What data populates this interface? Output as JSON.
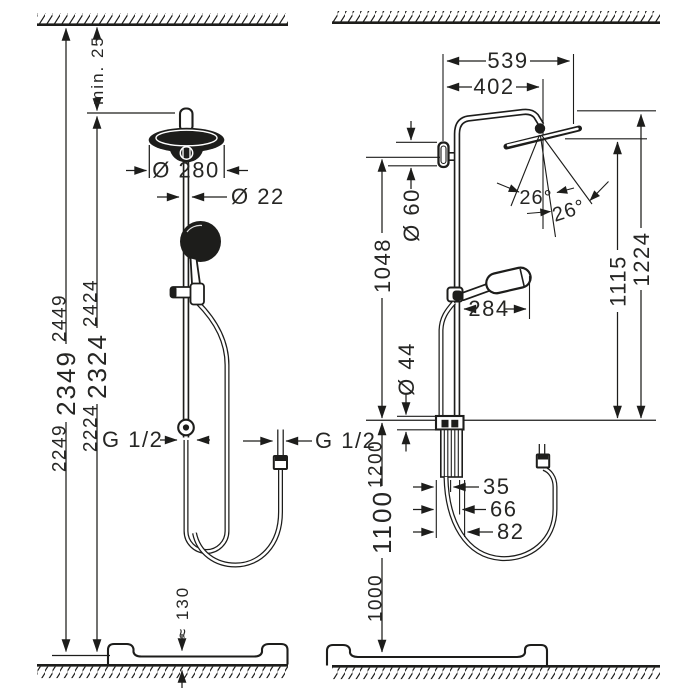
{
  "front_view": {
    "ceiling_gap": "min. 25",
    "head_diameter": "Ø 280",
    "pipe_diameter": "Ø 22",
    "height_total": {
      "low": "2249",
      "mid": "2349",
      "high": "2449"
    },
    "height_below_gap": {
      "low": "2224",
      "mid": "2324",
      "high": "2424"
    },
    "supply_thread": "G 1/2",
    "hose_thread": "G 1/2",
    "tray_height": "≈ 130"
  },
  "side_view": {
    "reach_overall": "539",
    "reach_arm": "402",
    "wall_escutcheon_diameter": "Ø 60",
    "supply_to_outlet_height": "1048",
    "spray_angle_left": "26°",
    "spray_angle_right": "26°",
    "clearance_head_bottom": "1115",
    "clearance_arm_top": "1224",
    "hand_shower_reach": "284",
    "outlet_diameter": "Ø 44",
    "outlet_height": {
      "low": "1000",
      "mid": "1100",
      "high": "1200"
    },
    "outlet_offset_small": "35",
    "outlet_offset_medium": "66",
    "outlet_offset_large": "82"
  },
  "colors": {
    "line": "#1d1d1b",
    "text": "#262624",
    "background": "#ffffff"
  }
}
